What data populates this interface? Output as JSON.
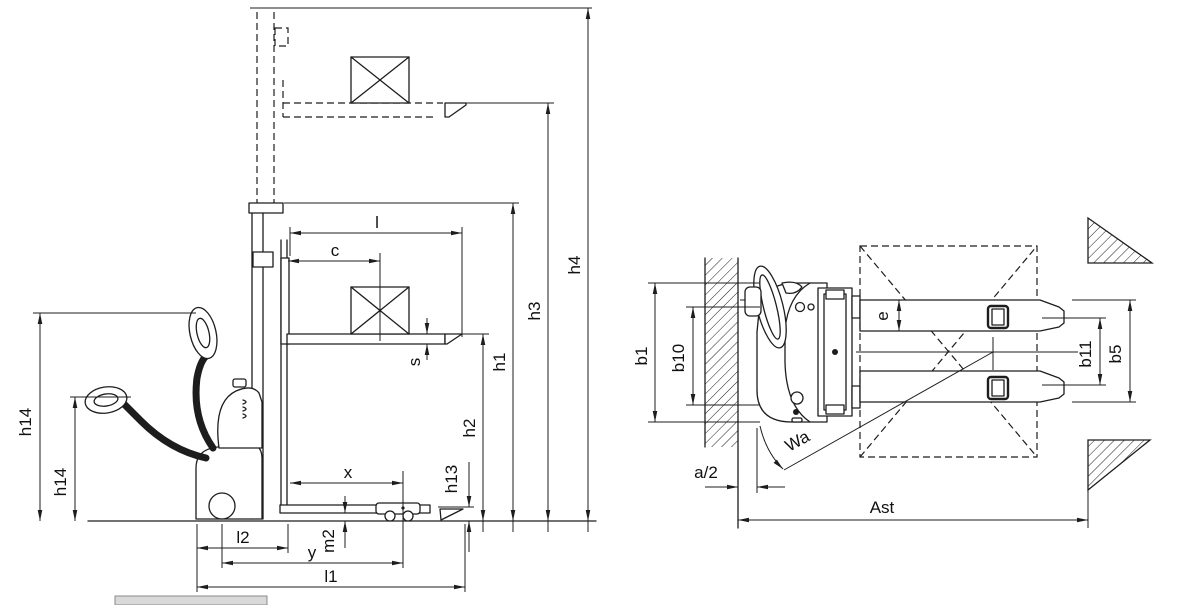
{
  "diagram": {
    "kind": "stacker-dimension-drawing",
    "colors": {
      "ink": "#1d1d1d",
      "background": "#ffffff",
      "caption_bar": "#d9d9d9"
    }
  },
  "side_view": {
    "labels": {
      "l": "l",
      "c": "c",
      "s": "s",
      "h1": "h1",
      "h2": "h2",
      "h3": "h3",
      "h4": "h4",
      "h13": "h13",
      "h14": "h14",
      "x": "x",
      "y": "y",
      "m2": "m2",
      "l1": "l1",
      "l2": "l2"
    }
  },
  "top_view": {
    "labels": {
      "b1": "b1",
      "b10": "b10",
      "b11": "b11",
      "b5": "b5",
      "e": "e",
      "Wa": "Wa",
      "a_half": "a/2",
      "Ast": "Ast"
    }
  }
}
